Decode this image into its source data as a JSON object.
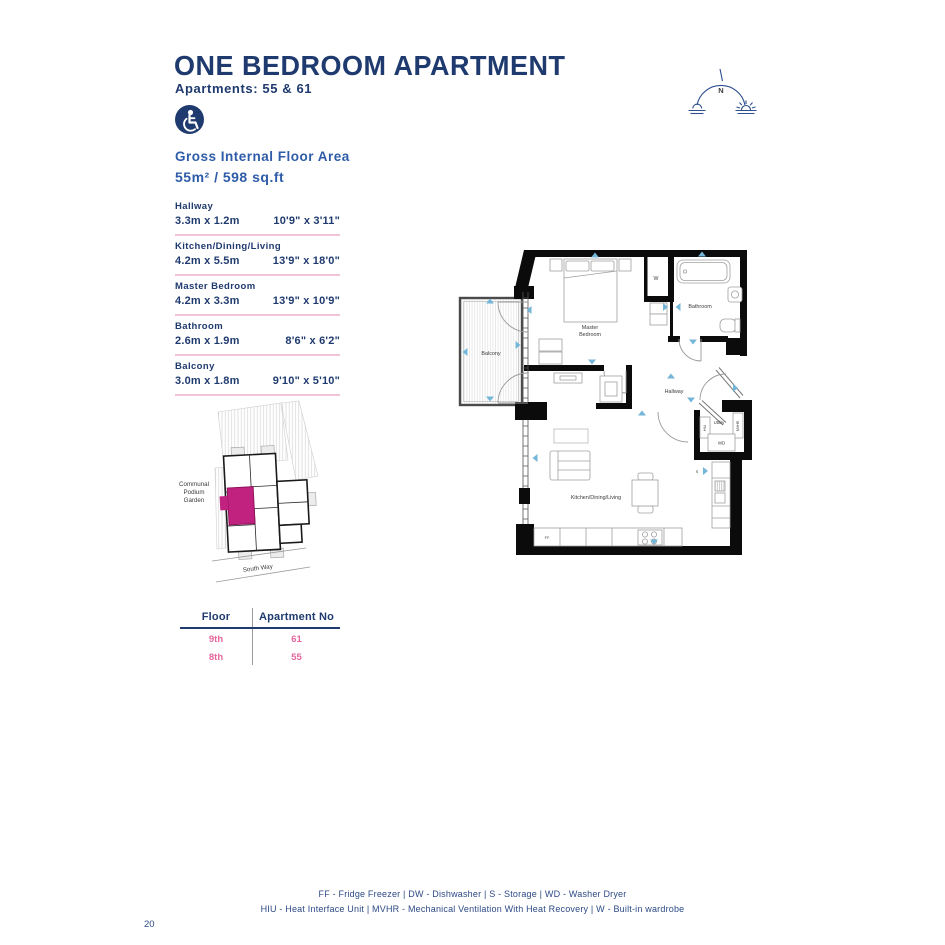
{
  "page_number": "20",
  "header": {
    "title": "ONE BEDROOM APARTMENT",
    "subtitle": "Apartments: 55 & 61"
  },
  "compass": {
    "north": "N"
  },
  "floor_area": {
    "label": "Gross Internal Floor Area",
    "value": "55m² / 598 sq.ft"
  },
  "rooms": [
    {
      "name": "Hallway",
      "metric": "3.3m x 1.2m",
      "imperial": "10'9\" x 3'11\""
    },
    {
      "name": "Kitchen/Dining/Living",
      "metric": "4.2m x 5.5m",
      "imperial": "13'9\" x 18'0\""
    },
    {
      "name": "Master Bedroom",
      "metric": "4.2m x 3.3m",
      "imperial": "13'9\" x 10'9\""
    },
    {
      "name": "Bathroom",
      "metric": "2.6m x 1.9m",
      "imperial": "8'6\" x 6'2\""
    },
    {
      "name": "Balcony",
      "metric": "3.0m x 1.8m",
      "imperial": "9'10\" x 5'10\""
    }
  ],
  "site_plan": {
    "garden_line1": "Communal",
    "garden_line2": "Podium",
    "garden_line3": "Garden",
    "street": "South Way"
  },
  "apartment_table": {
    "col1": "Floor",
    "col2": "Apartment No",
    "rows": [
      {
        "floor": "9th",
        "apartment": "61"
      },
      {
        "floor": "8th",
        "apartment": "55"
      }
    ]
  },
  "floor_plan_labels": {
    "balcony": "Balcony",
    "bedroom_line1": "Master",
    "bedroom_line2": "Bedroom",
    "bathroom": "Bathroom",
    "hallway": "Hallway",
    "utility": "Utility",
    "kitchen": "Kitchen/Dining/Living",
    "wardrobe": "W",
    "washer_dryer": "WD",
    "hiu": "HIU",
    "mvhr": "MVHR",
    "fridge_freezer": "FF",
    "storage": "S"
  },
  "legend": {
    "line1": "FF - Fridge Freezer | DW - Dishwasher | S - Storage | WD - Washer Dryer",
    "line2": "HIU - Heat Interface Unit | MVHR - Mechanical Ventilation With Heat Recovery | W - Built-in wardrobe"
  },
  "colors": {
    "navy": "#1f3a6e",
    "blue": "#2e5ca8",
    "pink": "#e5679e",
    "pink_light": "#f2c3d9",
    "magenta": "#c1217f",
    "arrow_blue": "#74b6d8"
  }
}
